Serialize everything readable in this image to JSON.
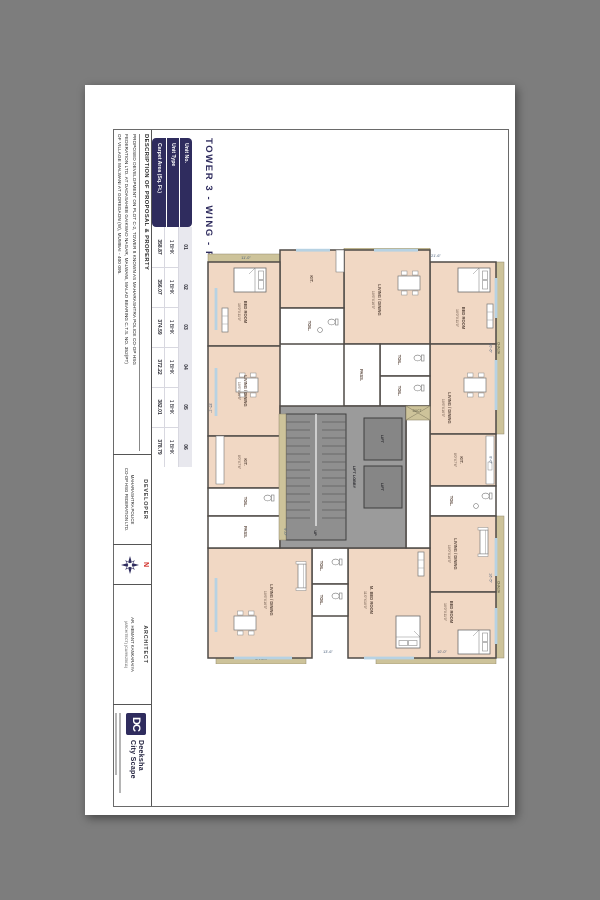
{
  "sheet": {
    "title": "TOWER 3 - WING - P"
  },
  "unit_table": {
    "headers": [
      "Unit No.",
      "Unit Type",
      "Carpet Area (Sq. Ft.)"
    ],
    "units": [
      {
        "no": "01",
        "type": "1 BHK",
        "area": "358.87"
      },
      {
        "no": "02",
        "type": "1 BHK",
        "area": "356.07"
      },
      {
        "no": "03",
        "type": "1 BHK",
        "area": "374.59"
      },
      {
        "no": "04",
        "type": "1 BHK",
        "area": "372.22"
      },
      {
        "no": "05",
        "type": "1 BHK",
        "area": "382.01"
      },
      {
        "no": "06",
        "type": "1 BHK",
        "area": "378.79"
      }
    ]
  },
  "titleblock": {
    "description": {
      "label": "DESCRIPTION OF PROPOSAL & PROPERTY",
      "line1": "PROPOSED DEVELOPMENT ON PLOT C-2, TOWER 8 KNOWN AS MAHARASHTRA POLICE CO-OP HSG",
      "line2": "FEDERATION LTD. AT DADASAHEB GAIKWAD NAGAR, MALWANI, MALAD BEARING C.T.S. NO. 352(PT)",
      "line3": "OF VILLAGE MALWANI AT GOREGAON (W), MUMBAI - 400 095."
    },
    "developer": {
      "label": "DEVELOPER",
      "line1": "MAHARASHTRA POLICE",
      "line2": "CO-OP HSG FEDERATION LTD."
    },
    "compass": {
      "north": "N"
    },
    "architect": {
      "label": "ARCHITECT",
      "line1": "AR. HEMANT KANKARAIYA",
      "line2": "(ARCHITECT) (CA/99/25011)"
    },
    "logo": {
      "monogram": "DC",
      "name_line1": "Deeksha",
      "name_line2": "City Scape"
    }
  },
  "plan": {
    "rooms": [
      {
        "name": "BED ROOM",
        "dims": "10'0\"X11'0\""
      },
      {
        "name": "LIVING / DINING",
        "dims": "10'6\"X16'5\""
      },
      {
        "name": "KIT.",
        "dims": "8'0\"X7'6\""
      },
      {
        "name": "TOIL.",
        "dims": ""
      },
      {
        "name": "LIVING / DINING",
        "dims": "10'0\"X16'5\""
      },
      {
        "name": "BED ROOM",
        "dims": "10'0\"X11'0\""
      },
      {
        "name": "LIVING / DINING",
        "dims": "10'6\"X16'5\""
      },
      {
        "name": "TOIL.",
        "dims": ""
      },
      {
        "name": "TOIL.",
        "dims": ""
      },
      {
        "name": "PASS.",
        "dims": ""
      },
      {
        "name": "M. BED ROOM",
        "dims": "11'0\"X10'0\""
      },
      {
        "name": "TOIL.",
        "dims": ""
      },
      {
        "name": "TOIL.",
        "dims": ""
      },
      {
        "name": "LIVING / DINING",
        "dims": "10'6\"X16'5\""
      },
      {
        "name": "BED ROOM",
        "dims": "10'0\"X11'0\""
      },
      {
        "name": "LIVING / DINING",
        "dims": "10'6\"X16'5\""
      },
      {
        "name": "KIT.",
        "dims": "8'0\"X7'6\""
      },
      {
        "name": "TOIL.",
        "dims": ""
      },
      {
        "name": "KIT.",
        "dims": "8'0\"X7'6\""
      },
      {
        "name": "PASS.",
        "dims": ""
      },
      {
        "name": "TOIL.",
        "dims": ""
      }
    ],
    "core": {
      "lift": "LIFT",
      "lift_lobby": "LIFT LOBBY",
      "up": "UP",
      "duct": "DUCT"
    },
    "chajja_label": "CHAJJA",
    "dims": [
      "10'-6\"",
      "8'-0\"",
      "16'-5\"",
      "21'-6\"",
      "11'-0\"",
      "10'-0\"",
      "13'-6\"",
      "35'-1\"",
      "9'-0\""
    ]
  },
  "colors": {
    "navy": "#2f2c5e",
    "room_beige": "#f1d8c4",
    "chajja_olive": "#cdc39a",
    "core_gray": "#9b9b9b",
    "window_blue": "#b7d2e3",
    "north_red": "#d02a23",
    "page_bg": "#7d7d7d",
    "unit_row_bg": "#e8e8ee"
  }
}
